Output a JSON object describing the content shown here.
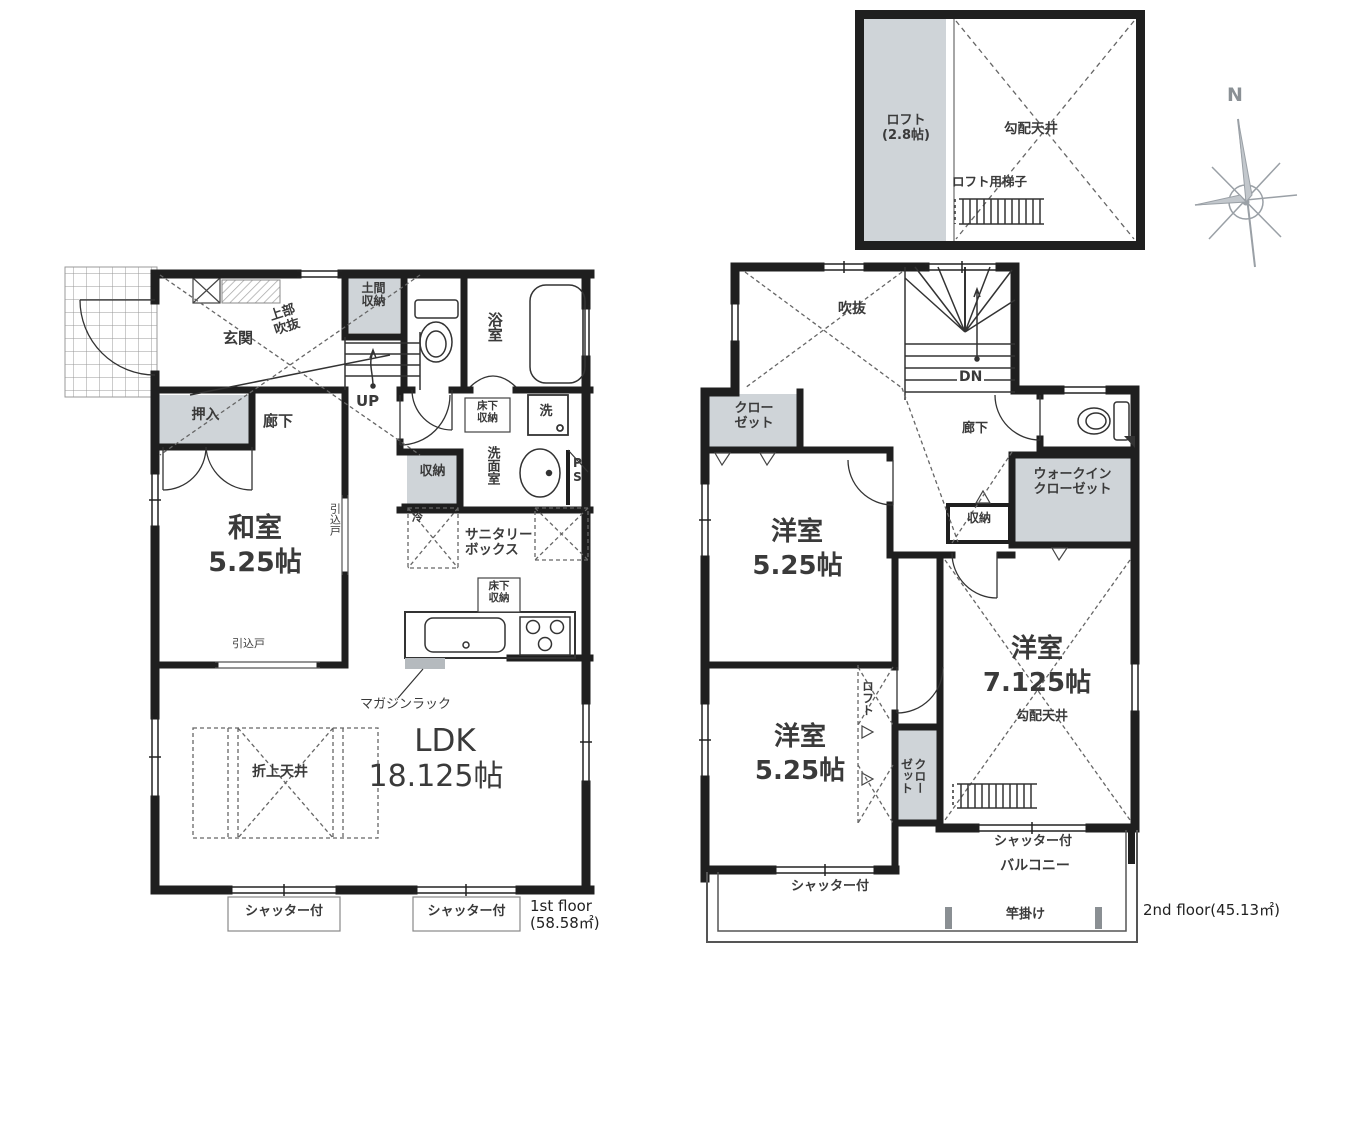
{
  "palette": {
    "wall": "#1f1f1f",
    "gray_fill": "#cfd4d8",
    "text": "#3a3a3a",
    "dash": "#666666"
  },
  "compass": {
    "north_label": "N"
  },
  "loft_plan": {
    "room_label_line1": "ロフト",
    "room_label_line2": "(2.8帖)",
    "ceiling_label": "勾配天井",
    "ladder_label": "ロフト用梯子"
  },
  "floor1": {
    "caption_line1": "1st floor",
    "caption_line2": "(58.58㎡)",
    "labels": {
      "entrance": "玄関",
      "upper_void_l1": "上部",
      "upper_void_l2": "吹抜",
      "doma_l1": "土間",
      "doma_l2": "収納",
      "bath": "浴室",
      "up": "UP",
      "oshiire": "押入",
      "hallway": "廊下",
      "underfloor1_l1": "床下",
      "underfloor1_l2": "収納",
      "washer": "洗",
      "washroom": "洗面室",
      "ps": "PS",
      "storage": "収納",
      "washitsu_name": "和室",
      "washitsu_size": "5.25帖",
      "sliding_door_right": "引込戸",
      "sliding_door_bottom": "引込戸",
      "fridge": "冷",
      "sanitary_l1": "サニタリー",
      "sanitary_l2": "ボックス",
      "underfloor2_l1": "床下",
      "underfloor2_l2": "収納",
      "magazine_rack": "マガジンラック",
      "ldk_name": "LDK",
      "ldk_size": "18.125帖",
      "coffered_ceiling": "折上天井",
      "shutter_left": "シャッター付",
      "shutter_right": "シャッター付"
    }
  },
  "floor2": {
    "caption": "2nd floor(45.13㎡)",
    "labels": {
      "void": "吹抜",
      "dn": "DN",
      "closet_l1": "クロー",
      "closet_l2": "ゼット",
      "hallway": "廊下",
      "wic_l1": "ウォークイン",
      "wic_l2": "クローゼット",
      "storage": "収納",
      "bedroom1_name": "洋室",
      "bedroom1_size": "5.25帖",
      "bedroom2_name": "洋室",
      "bedroom2_size": "7.125帖",
      "sloped_ceiling": "勾配天井",
      "loft": "ロフト",
      "closet2_l1": "クロー",
      "closet2_l2": "ゼット",
      "bedroom3_name": "洋室",
      "bedroom3_size": "5.25帖",
      "shutter_left": "シャッター付",
      "shutter_right": "シャッター付",
      "balcony": "バルコニー",
      "pole_hanger": "竿掛け"
    }
  }
}
